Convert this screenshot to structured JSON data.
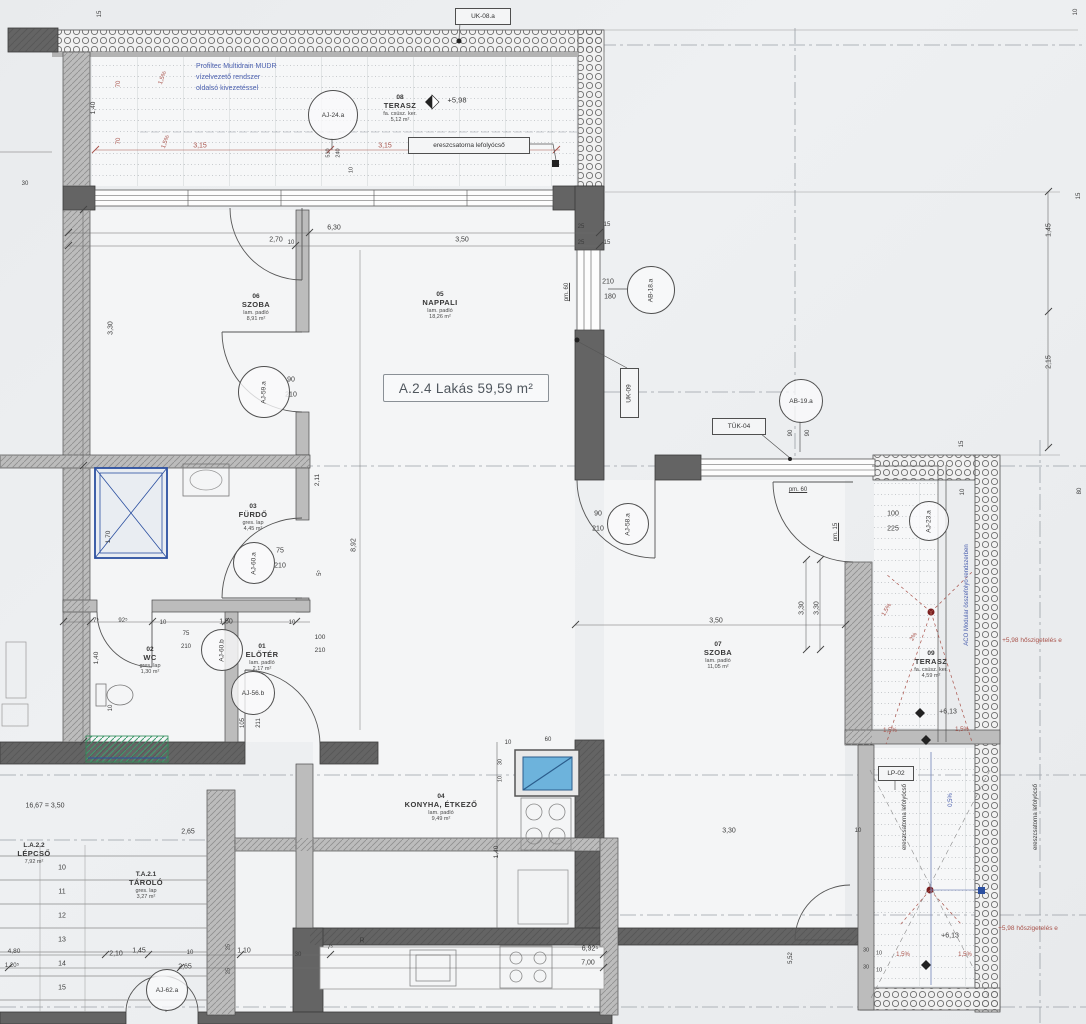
{
  "meta": {
    "unit": "A.2.4",
    "total_area": "59,59 m²"
  },
  "palette": {
    "paper": "#eceef0",
    "ink": "#3c3c3c",
    "wall_dark": "#606060",
    "wall_mid": "#b5b5b5",
    "dim_red": "#a8524a",
    "note_blue": "#4a5fae",
    "fixture_blue": "#6db3dc",
    "mat_green": "#3f9b6e"
  },
  "unit_label": {
    "text": "A.2.4 Lakás 59,59 m²",
    "x": 383,
    "y": 374,
    "w": 164,
    "h": 26
  },
  "notes": {
    "drain_system": {
      "lines": [
        "Profiltec Multidrain MUDR",
        "vízelvezető rendszer",
        "oldalsó kivezetéssel"
      ],
      "x": 196,
      "y": 62
    }
  },
  "rooms": [
    {
      "num": "06",
      "name": "SZOBA",
      "l1": "lam. padló",
      "l2": "8,91 m²",
      "cx": 256,
      "top": 293
    },
    {
      "num": "05",
      "name": "NAPPALI",
      "l1": "lam. padló",
      "l2": "18,26 m²",
      "cx": 440,
      "top": 291
    },
    {
      "num": "08",
      "name": "TERASZ",
      "l1": "fa. csúsz. ker.",
      "l2": "5,12 m²",
      "cx": 400,
      "top": 94
    },
    {
      "num": "03",
      "name": "FÜRDŐ",
      "l1": "gres. lap",
      "l2": "4,45 m²",
      "cx": 253,
      "top": 503
    },
    {
      "num": "02",
      "name": "WC",
      "l1": "gres. lap",
      "l2": "1,30 m²",
      "cx": 150,
      "top": 646
    },
    {
      "num": "01",
      "name": "ELŐTÉR",
      "l1": "lam. padló",
      "l2": "2,17 m²",
      "cx": 262,
      "top": 643
    },
    {
      "num": "04",
      "name": "KONYHA, ÉTKEZŐ",
      "l1": "lam. padló",
      "l2": "9,49 m²",
      "cx": 441,
      "top": 793
    },
    {
      "num": "07",
      "name": "SZOBA",
      "l1": "lam. padló",
      "l2": "11,05 m²",
      "cx": 718,
      "top": 641
    },
    {
      "num": "09",
      "name": "TERASZ",
      "l1": "fa. csúsz. ker.",
      "l2": "4,59 m²",
      "cx": 931,
      "top": 650
    },
    {
      "num": "L.A.2.2",
      "name": "LÉPCSŐ",
      "l1": "7,92 m²",
      "l2": "",
      "cx": 34,
      "top": 842
    },
    {
      "num": "T.A.2.1",
      "name": "TÁROLÓ",
      "l1": "gres. lap",
      "l2": "3,27 m²",
      "cx": 146,
      "top": 871
    }
  ],
  "tags": [
    {
      "label": "AJ-24.a",
      "cx": 332,
      "cy": 114,
      "r": 24
    },
    {
      "label": "AB-18.a",
      "cx": 650,
      "cy": 289,
      "r": 23,
      "rot": true
    },
    {
      "label": "AB-19.a",
      "cx": 800,
      "cy": 400,
      "r": 21
    },
    {
      "label": "AJ-59.a",
      "cx": 263,
      "cy": 391,
      "r": 25,
      "rot": true
    },
    {
      "label": "AJ-60.a",
      "cx": 253,
      "cy": 562,
      "r": 20,
      "rot": true
    },
    {
      "label": "AJ-60.b",
      "cx": 221,
      "cy": 649,
      "r": 20,
      "rot": true
    },
    {
      "label": "AJ-56.b",
      "cx": 252,
      "cy": 692,
      "r": 21
    },
    {
      "label": "AJ-58.a",
      "cx": 627,
      "cy": 523,
      "r": 20,
      "rot": true
    },
    {
      "label": "AJ-23.a",
      "cx": 928,
      "cy": 520,
      "r": 19,
      "rot": true
    },
    {
      "label": "AJ-62.a",
      "cx": 166,
      "cy": 989,
      "r": 20
    }
  ],
  "ref_boxes": [
    {
      "label": "UK-08.a",
      "x": 455,
      "y": 8,
      "w": 54,
      "h": 15
    },
    {
      "label": "ereszcsatorna lefolyócső",
      "x": 408,
      "y": 137,
      "w": 120,
      "h": 15
    },
    {
      "label": "UK-09",
      "x": 620,
      "y": 368,
      "w": 17,
      "h": 48,
      "rot": true
    },
    {
      "label": "TÜK-04",
      "x": 712,
      "y": 418,
      "w": 52,
      "h": 15
    },
    {
      "label": "LP-02",
      "x": 878,
      "y": 766,
      "w": 34,
      "h": 13
    }
  ],
  "annotations": [
    {
      "t": "15",
      "x": 100,
      "y": 14,
      "r": -90,
      "s": 6
    },
    {
      "t": "10",
      "x": 1076,
      "y": 12,
      "r": -90,
      "s": 6
    },
    {
      "t": "15",
      "x": 1079,
      "y": 196,
      "r": -90,
      "s": 6
    },
    {
      "t": "1,45",
      "x": 1049,
      "y": 230,
      "r": -90
    },
    {
      "t": "2,15",
      "x": 1049,
      "y": 362,
      "r": -90
    },
    {
      "t": "80",
      "x": 1080,
      "y": 491,
      "r": -90,
      "s": 6
    },
    {
      "t": "1,40",
      "x": 94,
      "y": 108,
      "r": -90,
      "s": 6.5
    },
    {
      "t": "70",
      "x": 119,
      "y": 84,
      "r": -90,
      "c": "red",
      "s": 6
    },
    {
      "t": "70",
      "x": 119,
      "y": 141,
      "r": -90,
      "c": "red",
      "s": 6
    },
    {
      "t": "1,5%",
      "x": 163,
      "y": 78,
      "r": -70,
      "c": "red",
      "s": 6
    },
    {
      "t": "1,5%",
      "x": 166,
      "y": 142,
      "r": -70,
      "c": "red",
      "s": 6
    },
    {
      "t": "3,15",
      "x": 200,
      "y": 146,
      "c": "red"
    },
    {
      "t": "3,15",
      "x": 385,
      "y": 146,
      "c": "red"
    },
    {
      "t": "510",
      "x": 329,
      "y": 153,
      "r": -90,
      "s": 5.5
    },
    {
      "t": "240",
      "x": 339,
      "y": 153,
      "r": -90,
      "s": 5.5
    },
    {
      "t": "10",
      "x": 352,
      "y": 170,
      "r": -90,
      "s": 5.5
    },
    {
      "t": "+5,98",
      "x": 457,
      "y": 100,
      "s": 7.5,
      "n": "elevation-label"
    },
    {
      "t": "30",
      "x": 25,
      "y": 184,
      "s": 6
    },
    {
      "t": "2,70",
      "x": 276,
      "y": 240
    },
    {
      "t": "6,30",
      "x": 334,
      "y": 228
    },
    {
      "t": "3,50",
      "x": 462,
      "y": 240
    },
    {
      "t": "10",
      "x": 291,
      "y": 243,
      "s": 6
    },
    {
      "t": "25",
      "x": 581,
      "y": 227,
      "s": 6
    },
    {
      "t": "15",
      "x": 607,
      "y": 225,
      "s": 6
    },
    {
      "t": "25",
      "x": 581,
      "y": 243,
      "s": 6
    },
    {
      "t": "15",
      "x": 607,
      "y": 243,
      "s": 6
    },
    {
      "t": "210",
      "x": 608,
      "y": 282
    },
    {
      "t": "180",
      "x": 610,
      "y": 297
    },
    {
      "t": "pm. 60",
      "x": 567,
      "y": 292,
      "r": -90,
      "s": 6,
      "u": true
    },
    {
      "t": "3,30",
      "x": 111,
      "y": 328,
      "r": -90
    },
    {
      "t": "90",
      "x": 291,
      "y": 380
    },
    {
      "t": "210",
      "x": 291,
      "y": 395
    },
    {
      "t": "2,11",
      "x": 318,
      "y": 480,
      "r": -90,
      "s": 6.5
    },
    {
      "t": "8,92",
      "x": 354,
      "y": 545,
      "r": -90
    },
    {
      "t": "1,70",
      "x": 109,
      "y": 537,
      "r": -90,
      "s": 6.5
    },
    {
      "t": "75",
      "x": 280,
      "y": 551
    },
    {
      "t": "210",
      "x": 280,
      "y": 566
    },
    {
      "t": "5⁵",
      "x": 320,
      "y": 573,
      "r": -90,
      "s": 6
    },
    {
      "t": "90",
      "x": 598,
      "y": 514
    },
    {
      "t": "210",
      "x": 598,
      "y": 529
    },
    {
      "t": "7⁵",
      "x": 96,
      "y": 621,
      "s": 6
    },
    {
      "t": "92⁵",
      "x": 123,
      "y": 621,
      "s": 6
    },
    {
      "t": "10",
      "x": 163,
      "y": 623,
      "s": 6
    },
    {
      "t": "1,50",
      "x": 226,
      "y": 622
    },
    {
      "t": "10",
      "x": 292,
      "y": 623,
      "s": 6
    },
    {
      "t": "75",
      "x": 186,
      "y": 634,
      "s": 6
    },
    {
      "t": "210",
      "x": 186,
      "y": 647,
      "s": 6
    },
    {
      "t": "100",
      "x": 320,
      "y": 638,
      "s": 6.5
    },
    {
      "t": "210",
      "x": 320,
      "y": 651,
      "s": 6.5
    },
    {
      "t": "1,40",
      "x": 97,
      "y": 658,
      "r": -90,
      "s": 6.5
    },
    {
      "t": "10",
      "x": 111,
      "y": 708,
      "r": -90,
      "s": 6
    },
    {
      "t": "105",
      "x": 243,
      "y": 723,
      "r": -90,
      "s": 6
    },
    {
      "t": "211",
      "x": 259,
      "y": 723,
      "r": -90,
      "s": 6
    },
    {
      "t": "100",
      "x": 893,
      "y": 514
    },
    {
      "t": "225",
      "x": 893,
      "y": 529
    },
    {
      "t": "pm. 60",
      "x": 798,
      "y": 490,
      "s": 6,
      "u": true
    },
    {
      "t": "pm. 15",
      "x": 836,
      "y": 532,
      "r": -90,
      "s": 6,
      "u": true
    },
    {
      "t": "3,50",
      "x": 716,
      "y": 621
    },
    {
      "t": "3,30",
      "x": 802,
      "y": 608,
      "r": -90
    },
    {
      "t": "3,30",
      "x": 817,
      "y": 608,
      "r": -90
    },
    {
      "t": "90",
      "x": 791,
      "y": 433,
      "r": -90,
      "s": 6
    },
    {
      "t": "90",
      "x": 808,
      "y": 433,
      "r": -90,
      "s": 6
    },
    {
      "t": "15",
      "x": 962,
      "y": 444,
      "r": -90,
      "s": 6
    },
    {
      "t": "10",
      "x": 963,
      "y": 492,
      "r": -90,
      "s": 6
    },
    {
      "t": "1,5%",
      "x": 887,
      "y": 610,
      "r": -60,
      "c": "red",
      "s": 6
    },
    {
      "t": "2%",
      "x": 914,
      "y": 637,
      "r": -60,
      "c": "red",
      "s": 6
    },
    {
      "t": "+6,13",
      "x": 948,
      "y": 712,
      "s": 7,
      "n": "elevation-label"
    },
    {
      "t": "1,5%",
      "x": 890,
      "y": 731,
      "c": "red",
      "s": 6
    },
    {
      "t": "1,5%",
      "x": 962,
      "y": 730,
      "c": "red",
      "s": 6
    },
    {
      "t": "0,5%",
      "x": 951,
      "y": 800,
      "r": -90,
      "c": "blue",
      "s": 6
    },
    {
      "t": "ereszcsatorna lefolyócső",
      "x": 905,
      "y": 817,
      "r": -90,
      "s": 6,
      "n": "drain-note"
    },
    {
      "t": "ereszcsatorna lefolyócső",
      "x": 1036,
      "y": 817,
      "r": -90,
      "s": 6,
      "n": "drain-note"
    },
    {
      "t": "ACO Modular összefolyó rendszerben",
      "x": 967,
      "y": 595,
      "r": -90,
      "c": "blue",
      "s": 6,
      "n": "aco-note"
    },
    {
      "t": "+5,98 hőszigetelés e",
      "x": 1032,
      "y": 641,
      "c": "red",
      "s": 6.5,
      "n": "insulation-note"
    },
    {
      "t": "+5,98 hőszigetelés e",
      "x": 1028,
      "y": 929,
      "c": "red",
      "s": 6.5,
      "n": "insulation-note"
    },
    {
      "t": "+6,13",
      "x": 950,
      "y": 936,
      "s": 7,
      "n": "elevation-label"
    },
    {
      "t": "1,5%",
      "x": 903,
      "y": 955,
      "c": "red",
      "s": 6
    },
    {
      "t": "1,5%",
      "x": 965,
      "y": 955,
      "c": "red",
      "s": 6
    },
    {
      "t": "30",
      "x": 866,
      "y": 951,
      "s": 5.5
    },
    {
      "t": "10",
      "x": 879,
      "y": 954,
      "s": 5.5
    },
    {
      "t": "30",
      "x": 866,
      "y": 968,
      "s": 5.5
    },
    {
      "t": "10",
      "x": 879,
      "y": 971,
      "s": 5.5
    },
    {
      "t": "3,30",
      "x": 729,
      "y": 831
    },
    {
      "t": "10",
      "x": 858,
      "y": 831,
      "s": 6
    },
    {
      "t": "10",
      "x": 508,
      "y": 743,
      "s": 6
    },
    {
      "t": "60",
      "x": 548,
      "y": 740,
      "s": 6
    },
    {
      "t": "30",
      "x": 501,
      "y": 762,
      "r": -90,
      "s": 5.5
    },
    {
      "t": "10",
      "x": 501,
      "y": 779,
      "r": -90,
      "s": 5.5
    },
    {
      "t": "1,40",
      "x": 497,
      "y": 852,
      "r": -90,
      "s": 6.5
    },
    {
      "t": "16,67 = 3,50",
      "x": 45,
      "y": 806,
      "s": 7,
      "n": "stair-formula"
    },
    {
      "t": "2,65",
      "x": 188,
      "y": 832
    },
    {
      "t": "25",
      "x": 229,
      "y": 947,
      "r": -90,
      "s": 5.5
    },
    {
      "t": "25",
      "x": 229,
      "y": 971,
      "r": -90,
      "s": 5.5
    },
    {
      "t": "10",
      "x": 62,
      "y": 868,
      "n": "stair-step-number"
    },
    {
      "t": "11",
      "x": 62,
      "y": 892,
      "n": "stair-step-number"
    },
    {
      "t": "12",
      "x": 62,
      "y": 916,
      "n": "stair-step-number"
    },
    {
      "t": "13",
      "x": 62,
      "y": 940,
      "n": "stair-step-number"
    },
    {
      "t": "14",
      "x": 62,
      "y": 964,
      "n": "stair-step-number"
    },
    {
      "t": "15",
      "x": 62,
      "y": 988,
      "n": "stair-step-number"
    },
    {
      "t": "4,80",
      "x": 14,
      "y": 952,
      "s": 6.5
    },
    {
      "t": "1,20⁵",
      "x": 12,
      "y": 966,
      "s": 6
    },
    {
      "t": "2,10",
      "x": 116,
      "y": 954
    },
    {
      "t": "1,45",
      "x": 139,
      "y": 951
    },
    {
      "t": "10",
      "x": 190,
      "y": 953,
      "s": 6
    },
    {
      "t": "1,10",
      "x": 244,
      "y": 951
    },
    {
      "t": "30",
      "x": 298,
      "y": 955,
      "s": 6
    },
    {
      "t": "7⁵",
      "x": 330,
      "y": 948,
      "s": 6
    },
    {
      "t": "2,65",
      "x": 185,
      "y": 967
    },
    {
      "t": "R",
      "x": 362,
      "y": 941,
      "s": 7
    },
    {
      "t": "6,92⁵",
      "x": 590,
      "y": 949
    },
    {
      "t": "7,00",
      "x": 588,
      "y": 963
    },
    {
      "t": "5,52",
      "x": 791,
      "y": 958,
      "r": -90,
      "s": 6
    }
  ]
}
